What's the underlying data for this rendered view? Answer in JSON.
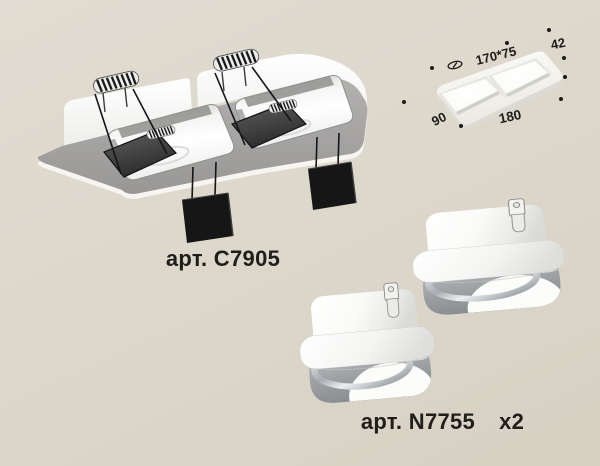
{
  "background": {
    "top_color": "#e1dcd1",
    "bottom_color": "#d7d1c4"
  },
  "captions": {
    "frame_sku": "арт. C7905",
    "insert_sku": "арт. N7755",
    "insert_qty": "x2"
  },
  "dimension_diagram": {
    "cutout_size": "170*75",
    "height": "42",
    "side_width": "90",
    "front_width": "180"
  },
  "palette": {
    "text": "#1d1b18",
    "plate_gray": "#a2a1a0",
    "fixture_white": "#fbfbf9",
    "hardware_black": "#161616",
    "chrome": "#c9ccce"
  }
}
